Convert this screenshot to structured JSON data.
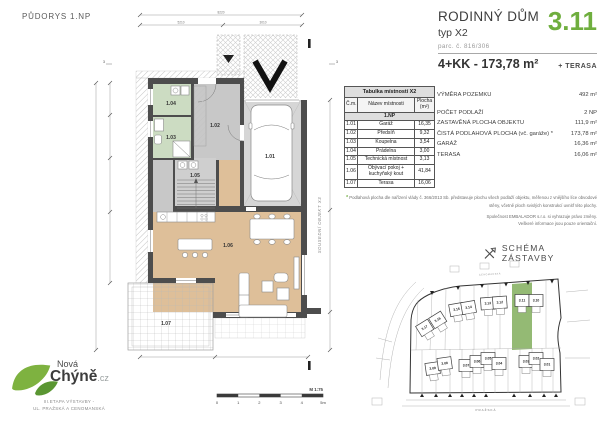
{
  "page": {
    "drawing_title": "PŮDORYS 1.NP"
  },
  "header": {
    "title": "RODINNÝ DŮM",
    "subtitle": "typ X2",
    "parcel": "parc. č. 816/306",
    "unit_number": "3.11",
    "layout_line": "4+KK - 173,78 m²",
    "layout_suffix": "+ TERASA",
    "accent_color": "#6fae3e"
  },
  "room_table": {
    "title": "Tabulka místností X2",
    "columns": [
      "Č.m.",
      "Název místnosti",
      "Plocha (m²)"
    ],
    "section": "1.NP",
    "rows": [
      {
        "num": "1.01",
        "name": "Garáž",
        "area": "16,35"
      },
      {
        "num": "1.02",
        "name": "Předsíň",
        "area": "9,32"
      },
      {
        "num": "1.03",
        "name": "Koupelna",
        "area": "3,54"
      },
      {
        "num": "1.04",
        "name": "Prádelna",
        "area": "3,00"
      },
      {
        "num": "1.05",
        "name": "Technická místnost",
        "area": "3,13"
      },
      {
        "num": "1.06",
        "name": "Obývací pokoj + kuchyňský kout",
        "area": "41,84"
      },
      {
        "num": "1.07",
        "name": "Terasa",
        "area": "16,06"
      }
    ]
  },
  "property_info": {
    "rows": [
      {
        "label": "VÝMĚRA POZEMKU",
        "value": "492 m²"
      },
      {
        "label": "POČET PODLAŽÍ",
        "value": "2 NP"
      },
      {
        "label": "ZASTAVĚNÁ PLOCHA OBJEKTU",
        "value": "111,9 m²"
      },
      {
        "label": "ČISTÁ PODLAHOVÁ PLOCHA (vč. garáže) *",
        "value": "173,78 m²"
      },
      {
        "label": "GARÁŽ",
        "value": "16,36 m²"
      },
      {
        "label": "TERASA",
        "value": "16,06 m²"
      }
    ]
  },
  "disclaimer": {
    "asterisk": "*",
    "line1": "Podlahová plocha dle nařízení vlády č. 366/2013 Sb. představuje plochu všech podlaží objektu, měřenou z vnějšího líce obvodové stěny, včetně ploch svislých konstrukcí uvnitř této plochy.",
    "line2": "Společnost EMBALADOR s.r.o. si vyhrazuje právo změny.",
    "line3": "Veškeré informace jsou pouze orientační."
  },
  "schema": {
    "heading": "SCHÉMA ZÁSTAVBY",
    "street_bottom": "PRAŽSKÁ",
    "street_top": "CENOMANSKÁ",
    "highlight_color": "#94ba74",
    "highlighted_house": "3.11",
    "houses": [
      "3.17",
      "3.16",
      "3.15",
      "3.14",
      "3.13",
      "3.12",
      "3.11",
      "3.10",
      "3.09",
      "3.08",
      "3.07",
      "3.06",
      "3.05",
      "3.04",
      "3.03",
      "3.02",
      "3.01"
    ]
  },
  "floor_plan": {
    "room_labels": [
      "1.01",
      "1.02",
      "1.03",
      "1.04",
      "1.05",
      "1.06",
      "1.07"
    ],
    "side_label": "SOUSEDNÍ OBJEKT X3",
    "scale_label": "M 1:75",
    "scale_ticks": [
      "0",
      "1",
      "2",
      "3",
      "4",
      "5m"
    ],
    "dims": {
      "top_total": "8220",
      "top_left": "5210",
      "top_right": "3010"
    },
    "section_marks": [
      "1",
      "3"
    ]
  },
  "logo": {
    "brand_top": "Nová",
    "brand_main": "Chýně",
    "brand_suffix": ".cz",
    "tagline1": "III.ETAPA VÝSTAVBY -",
    "tagline2": "UL. PRAŽSKÁ A CENOMANSKÁ",
    "leaf_color": "#7eb240"
  }
}
